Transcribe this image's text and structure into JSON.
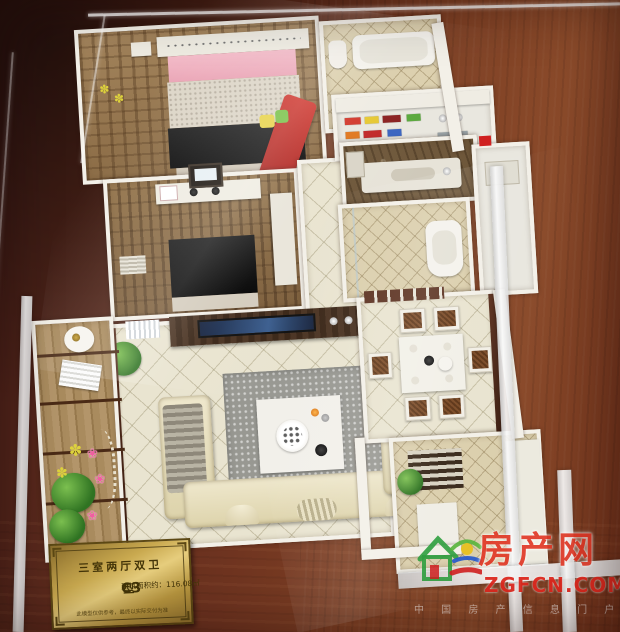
{
  "plaque": {
    "title": "三室两厅双卫",
    "model_code": "C3",
    "model_suffix": "型",
    "area_label": "建筑面积约：116.08㎡",
    "disclaimer": "此模型仅供参考，最终以实际交付为准"
  },
  "watermark": {
    "site_name": "房产网",
    "domain": "ZGFCN.COM",
    "tagline": "中 国 房 产 信 息 门 户"
  },
  "icons": {
    "flower": "❀",
    "flower_alt": "✽"
  },
  "colors": {
    "accent_red": "#e23a28",
    "logo_green": "#2f9e3f",
    "plaque_gold": "#caa94e",
    "wood_brown": "#6f3420"
  }
}
